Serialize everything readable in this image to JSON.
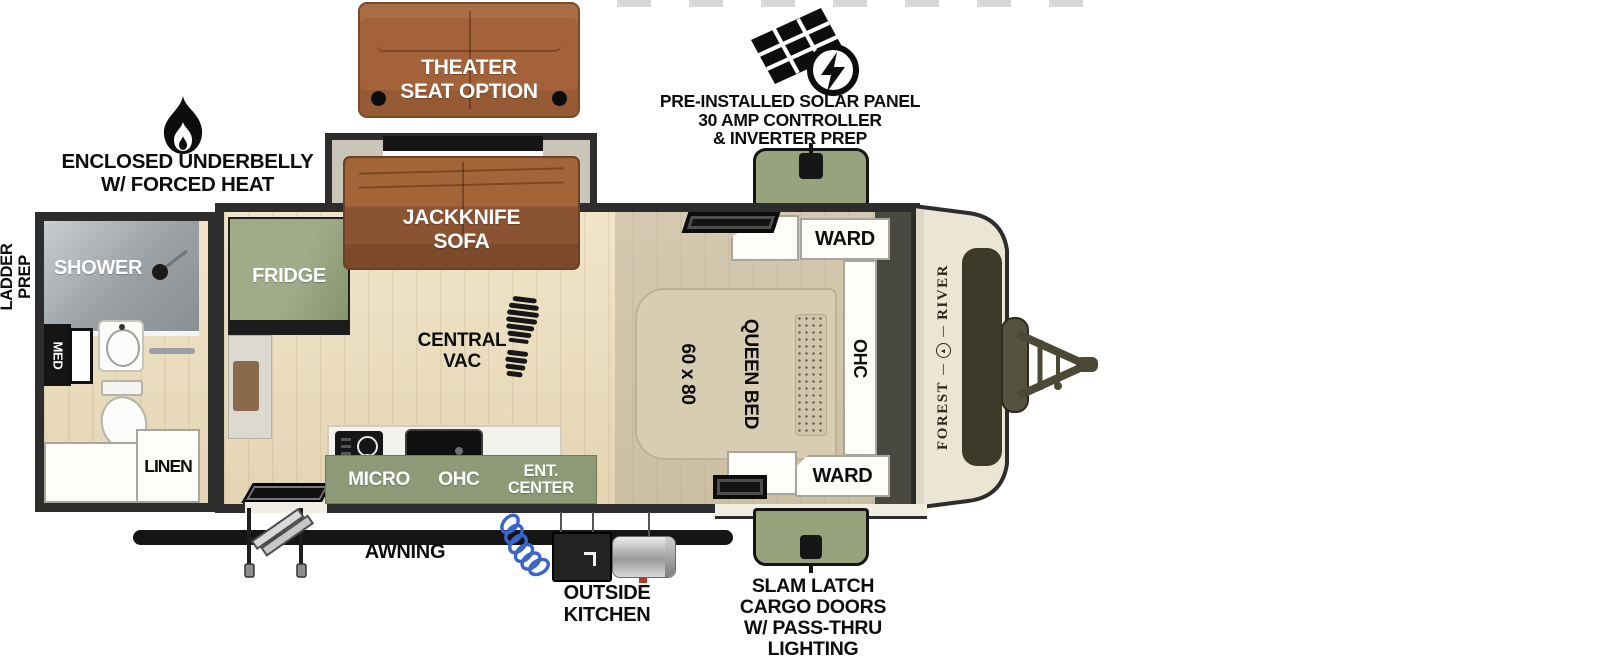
{
  "title": "Forest River travel trailer floor plan",
  "brand": {
    "name_word1": "FOREST",
    "name_word2": "RIVER"
  },
  "exterior": {
    "solar": {
      "lines": [
        "PRE-INSTALLED SOLAR PANEL",
        "30 AMP CONTROLLER",
        "& INVERTER PREP"
      ]
    },
    "underbelly": {
      "lines": [
        "ENCLOSED UNDERBELLY",
        "W/ FORCED HEAT"
      ]
    },
    "ladder_prep": {
      "lines": [
        "LADDER",
        "PREP"
      ]
    },
    "awning": {
      "label": "AWNING"
    },
    "outside_kitchen": {
      "lines": [
        "OUTSIDE",
        "KITCHEN"
      ]
    },
    "cargo_doors": {
      "lines": [
        "SLAM LATCH",
        "CARGO DOORS",
        "W/ PASS-THRU",
        "LIGHTING"
      ]
    },
    "theater_seat": {
      "lines": [
        "THEATER",
        "SEAT OPTION"
      ]
    }
  },
  "interior": {
    "jackknife_sofa": {
      "lines": [
        "JACKKNIFE",
        "SOFA"
      ]
    },
    "fridge": {
      "label": "FRIDGE"
    },
    "central_vac": {
      "lines": [
        "CENTRAL",
        "VAC"
      ]
    },
    "queen_bed": {
      "size": "60 x 80",
      "label": "QUEEN BED"
    },
    "ward_top": {
      "label": "WARD"
    },
    "ward_bottom": {
      "label": "WARD"
    },
    "ohc": {
      "label": "OHC"
    },
    "kitchen": {
      "micro": "MICRO",
      "ohc": "OHC",
      "ent_center": [
        "ENT.",
        "CENTER"
      ]
    },
    "bath": {
      "shower": "SHOWER",
      "med": "MED",
      "linen": "LINEN"
    }
  },
  "colors": {
    "wall": "#2d2d2d",
    "sage_green": "#98a37d",
    "sofa_brown": "#8a5332",
    "theater_brown": "#a3623a",
    "floor_wood": "#ecdfc1",
    "bed_beige": "#d8cdb2",
    "front_cap_cream": "#ebe6d3",
    "cap_window_olive": "#3b3927",
    "hose_blue": "#3c64c8"
  }
}
